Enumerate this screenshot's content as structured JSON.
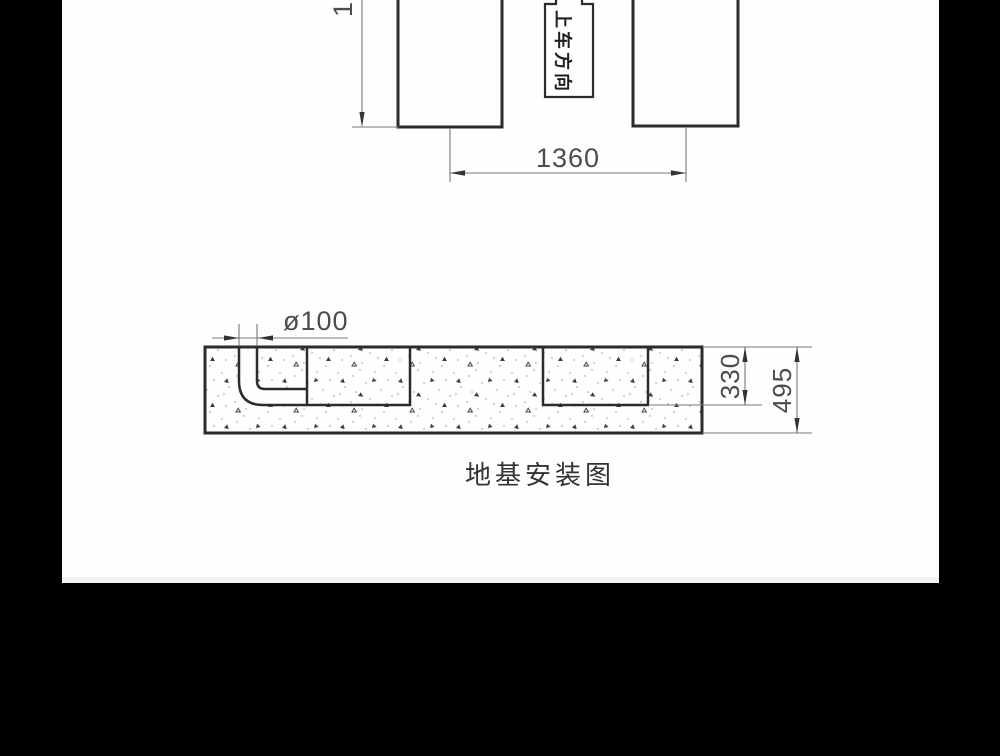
{
  "drawing": {
    "plan_view": {
      "direction_label": "上车方向",
      "span_dimension": "1360",
      "left_dimension_partial": "1"
    },
    "section_view": {
      "pipe_dimension": "ø100",
      "recess_depth_dimension": "330",
      "total_height_dimension": "495",
      "caption": "地基安装图"
    },
    "colors": {
      "background": "#000000",
      "paper": "#fefefe",
      "paper_bottom_edge": "#f3f3f3",
      "outline": "#2b2b2b",
      "dimension_line": "#787878",
      "dimension_text": "#4d4d4d",
      "hatch_triangle": "#3d3d3d",
      "hatch_dot": "#b3b3b3"
    }
  }
}
